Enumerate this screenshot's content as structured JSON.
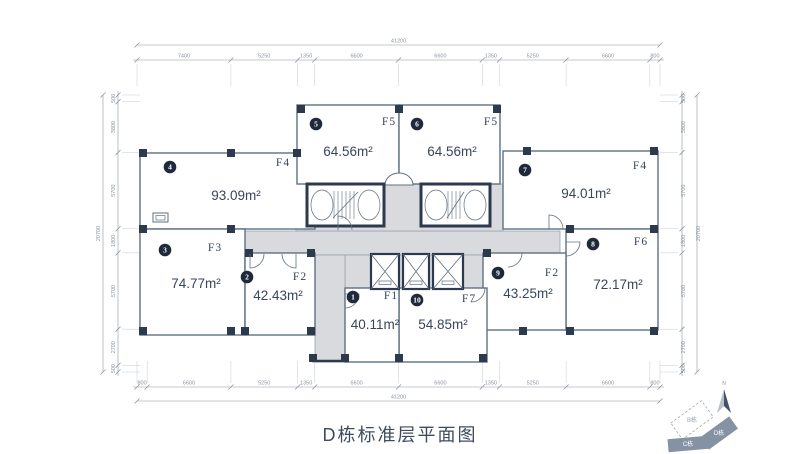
{
  "meta": {
    "title": "D栋标准层平面图"
  },
  "units": [
    {
      "id": "1",
      "circle": "1",
      "code": "F1",
      "area": "40.11m²"
    },
    {
      "id": "2",
      "circle": "2",
      "code": "F2",
      "area": "42.43m²"
    },
    {
      "id": "3",
      "circle": "3",
      "code": "F3",
      "area": "74.77m²"
    },
    {
      "id": "4",
      "circle": "4",
      "code": "F4",
      "area": "93.09m²"
    },
    {
      "id": "5",
      "circle": "5",
      "code": "F5",
      "area": "64.56m²"
    },
    {
      "id": "6",
      "circle": "6",
      "code": "F5",
      "area": "64.56m²"
    },
    {
      "id": "7",
      "circle": "7",
      "code": "F4",
      "area": "94.01m²"
    },
    {
      "id": "8",
      "circle": "8",
      "code": "F6",
      "area": "72.17m²"
    },
    {
      "id": "9",
      "circle": "9",
      "code": "F2",
      "area": "43.25m²"
    },
    {
      "id": "10",
      "circle": "10",
      "code": "F7",
      "area": "54.85m²"
    }
  ],
  "dimensions": {
    "top": {
      "total": "41200",
      "segments": [
        "7400",
        "5250",
        "1350",
        "6600",
        "6600",
        "1350",
        "5250",
        "6600",
        "800"
      ]
    },
    "bottom": {
      "total": "41200",
      "segments": [
        "800",
        "6600",
        "5250",
        "1350",
        "6600",
        "6600",
        "1350",
        "5250",
        "6600",
        "800"
      ]
    },
    "left": {
      "total": "20700",
      "segments": [
        "500",
        "3800",
        "5700",
        "1800",
        "5700",
        "2700",
        "500"
      ]
    },
    "right": {
      "total": "20700",
      "segments": [
        "500",
        "3800",
        "5700",
        "1800",
        "5700",
        "2700",
        "500"
      ]
    }
  },
  "compass": {
    "label": "N"
  },
  "keymap": {
    "buildings": [
      {
        "label": "B栋",
        "style": "dashed"
      },
      {
        "label": "D栋",
        "style": "filled"
      },
      {
        "label": "C栋",
        "style": "filled"
      }
    ]
  },
  "colors": {
    "column": "#2d3a4d",
    "wall": "#5e7082",
    "corridor": "#d8dadd",
    "corridor_edge": "#97a2ad",
    "text": "#37465a",
    "dim": "#8b96a2",
    "witness": "#c3cbd3",
    "keymap_fill": "#8492a4"
  }
}
